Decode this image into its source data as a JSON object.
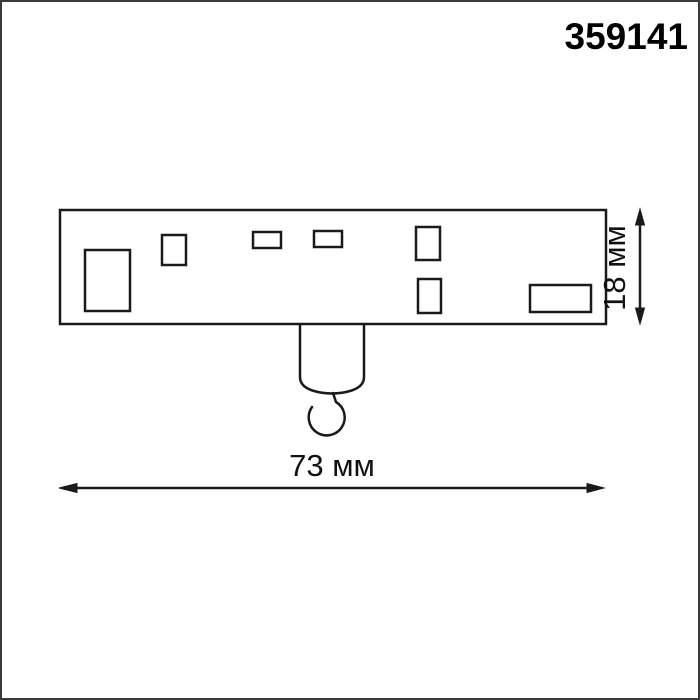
{
  "page": {
    "product_code": "359141",
    "background_color": "#ffffff",
    "border_color": "#3b3b3b",
    "line_color": "#1a1a1a",
    "text_color": "#000000"
  },
  "drawing": {
    "type": "product-dimension-drawing",
    "width_dimension": {
      "label": "73 мм",
      "value_mm": 73,
      "unit": "мм"
    },
    "height_dimension": {
      "label": "18 мм",
      "value_mm": 18,
      "unit": "мм"
    }
  }
}
